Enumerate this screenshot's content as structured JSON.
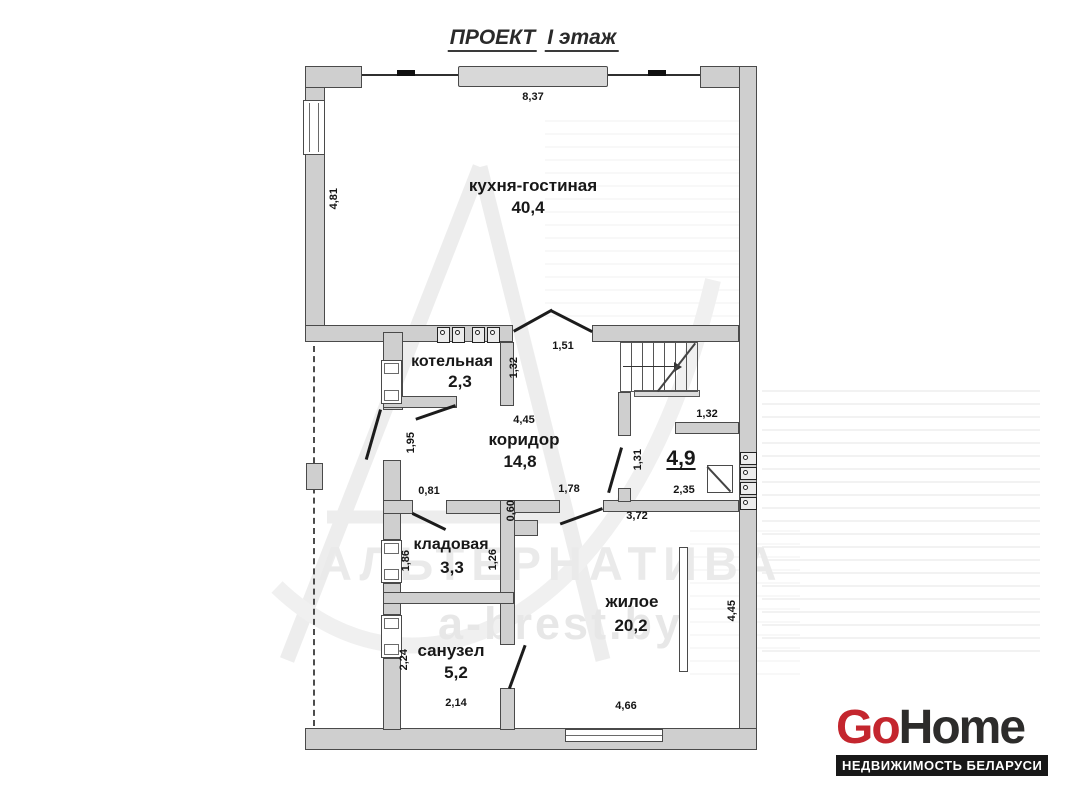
{
  "title": {
    "part1": "ПРОЕКТ",
    "part2": "I этаж"
  },
  "rooms": {
    "kitchen": {
      "label": "кухня-гостиная",
      "area": "40,4"
    },
    "boiler": {
      "label": "котельная",
      "area": "2,3"
    },
    "corridor": {
      "label": "коридор",
      "area": "14,8"
    },
    "hall": {
      "area": "4,9"
    },
    "pantry": {
      "label": "кладовая",
      "area": "3,3"
    },
    "bathroom": {
      "label": "санузел",
      "area": "5,2"
    },
    "living": {
      "label": "жилое",
      "area": "20,2"
    }
  },
  "dims": {
    "top_width": "8,37",
    "kitchen_left_height": "4,81",
    "kitchen_door_width": "1,51",
    "boiler_right_height": "1,32",
    "corridor_width": "4,45",
    "corridor_left_height": "1,95",
    "hall_left_height": "1,31",
    "stair_stub_width": "1,32",
    "hall_width": "2,35",
    "pantry_door_width": "0,81",
    "living_door_width": "1,78",
    "pantry_jog_height": "0,60",
    "living_top_width": "3,72",
    "pantry_left_height": "1,86",
    "pantry_right_height": "1,26",
    "bathroom_left_height": "2,24",
    "bathroom_bottom_width": "2,14",
    "living_bottom_width": "4,66",
    "living_right_height": "4,45"
  },
  "watermark": {
    "line1": "АЛЬТЕРНАТИВА",
    "line2": "a-brest.by"
  },
  "logo": {
    "brand_red": "Go",
    "brand_dark": "Home",
    "tagline": "НЕДВИЖИМОСТЬ БЕЛАРУСИ",
    "accent_color": "#c4262e",
    "dark_color": "#2d2c2b"
  }
}
